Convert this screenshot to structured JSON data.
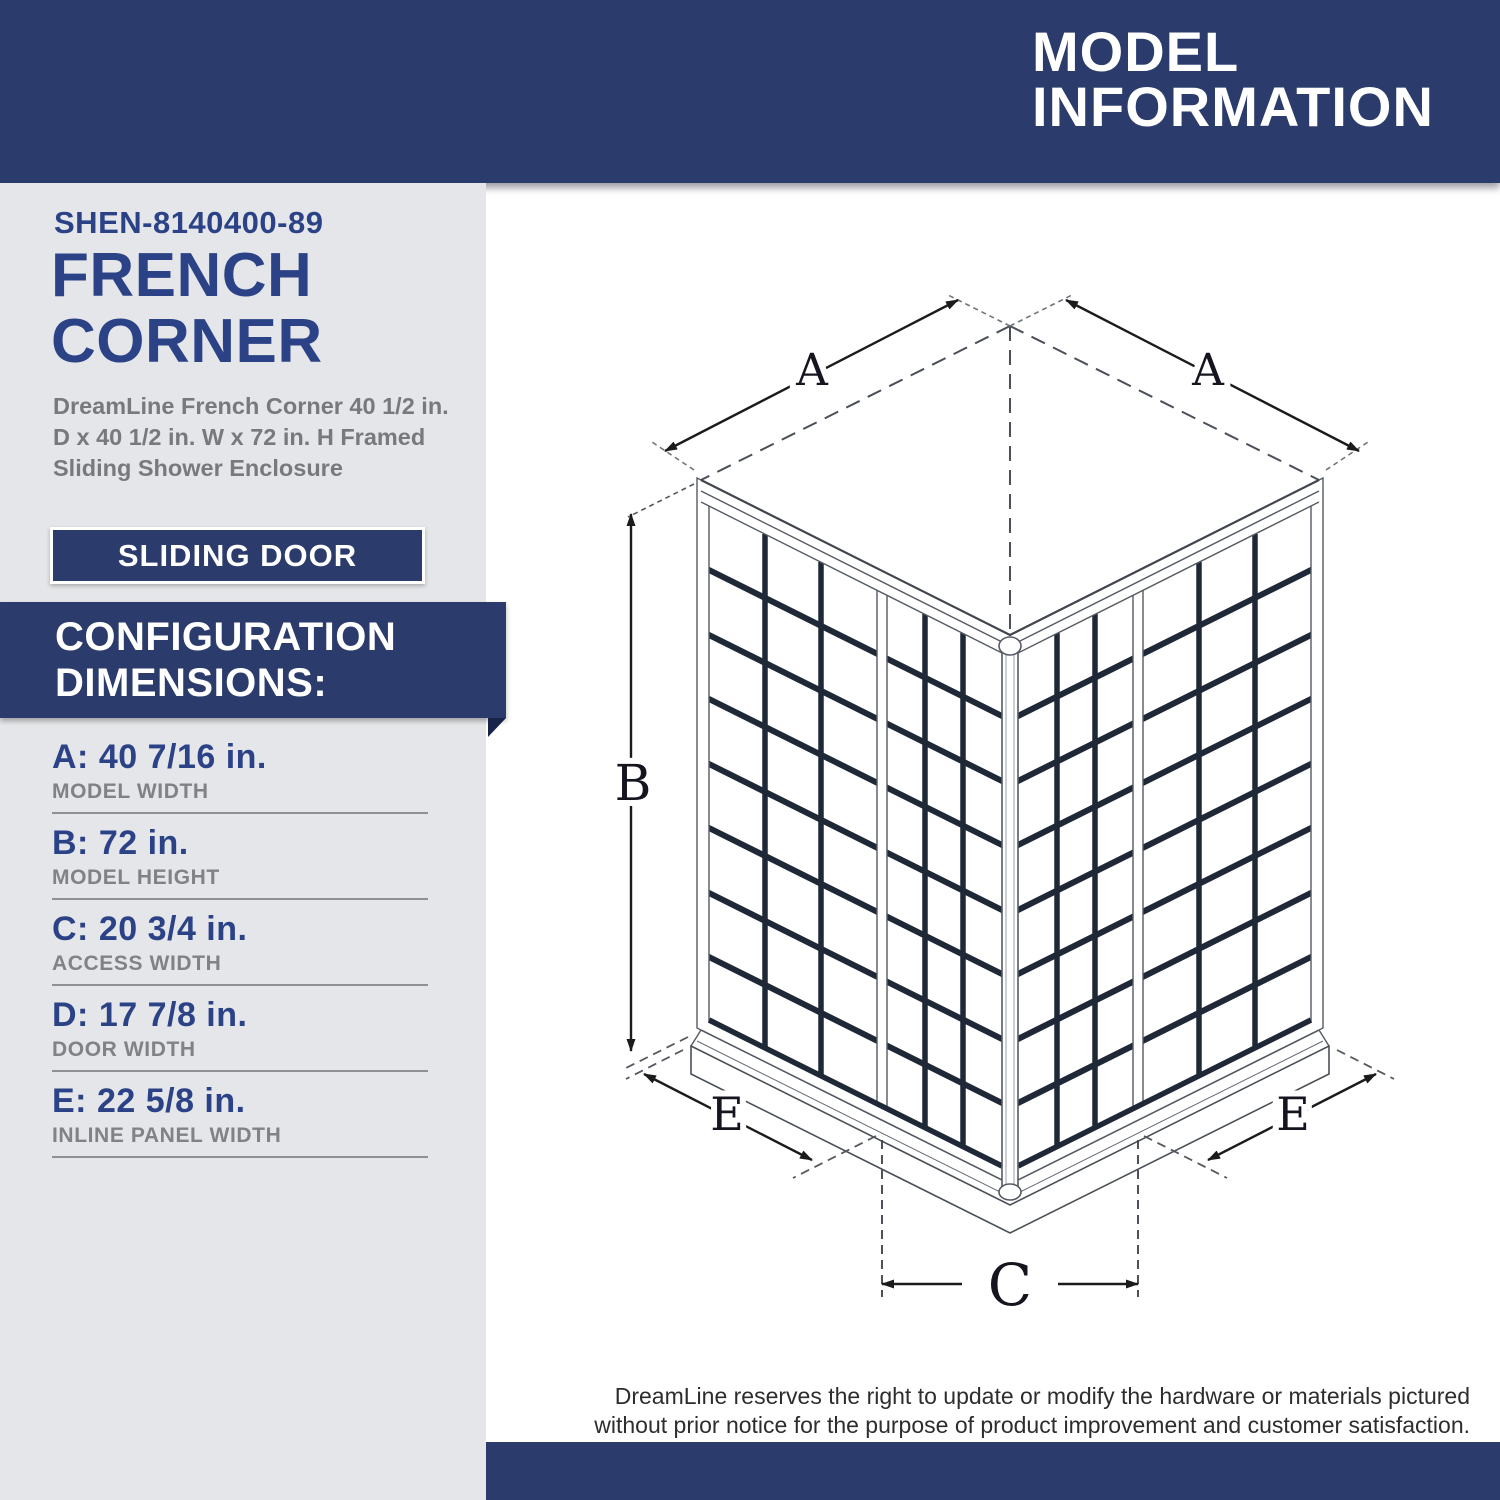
{
  "header": {
    "title_line1": "MODEL",
    "title_line2": "INFORMATION"
  },
  "sidebar": {
    "model_number": "SHEN-8140400-89",
    "product_name_line1": "FRENCH",
    "product_name_line2": "CORNER",
    "description_lines": [
      "DreamLine French Corner 40 1/2 in.",
      "D x 40 1/2 in. W x 72 in. H Framed",
      "Sliding Shower Enclosure"
    ],
    "door_type_badge": "SLIDING DOOR",
    "section_heading_line1": "CONFIGURATION",
    "section_heading_line2": "DIMENSIONS:",
    "dimensions": [
      {
        "value_text": "A: 40 7/16 in.",
        "label": "MODEL WIDTH"
      },
      {
        "value_text": "B: 72 in.",
        "label": "MODEL HEIGHT"
      },
      {
        "value_text": "C: 20 3/4 in.",
        "label": "ACCESS WIDTH"
      },
      {
        "value_text": "D: 17 7/8 in.",
        "label": "DOOR WIDTH"
      },
      {
        "value_text": "E: 22 5/8 in.",
        "label": "INLINE PANEL WIDTH"
      }
    ]
  },
  "diagram": {
    "model_width_label": "A",
    "model_height_label": "B",
    "access_width_label": "C",
    "inline_panel_label": "E"
  },
  "footer": {
    "disclaimer_line1": "DreamLine reserves the right to update or modify the hardware or materials pictured",
    "disclaimer_line2": "without prior notice for the purpose of product improvement and customer satisfaction."
  },
  "colors": {
    "navy": "#2b3b6b",
    "royal_blue": "#2c4287",
    "ribbon_fold": "#18234a",
    "description_gray": "#77797d",
    "label_gray": "#808285",
    "sidebar_bg": "#e4e6e9",
    "grid_line_dark": "#1f2837"
  }
}
